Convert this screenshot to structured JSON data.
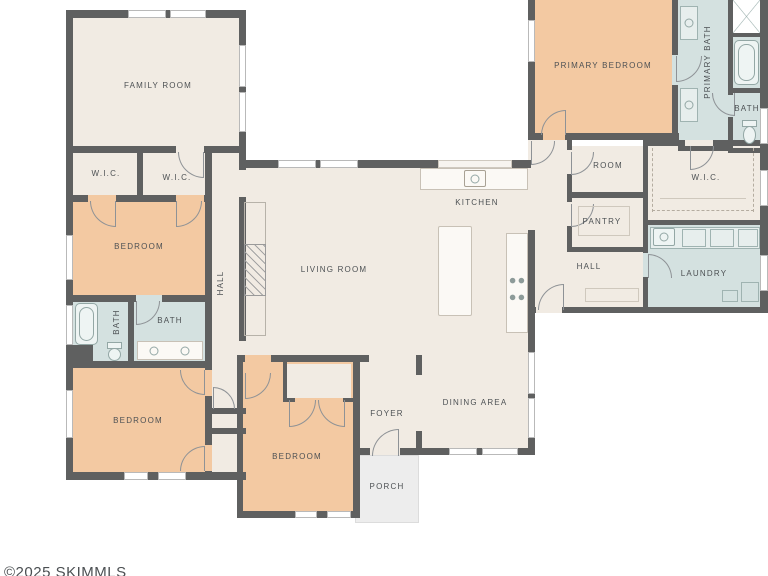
{
  "title": "Single-story house floor plan",
  "watermark": "©2025 SKIMMLS",
  "colors": {
    "background": "#ffffff",
    "wall": "#5f6060",
    "floor_common": "#f1ebe3",
    "floor_bedroom": "#f3c9a2",
    "floor_bath": "#d4e1e0",
    "floor_porch": "#ededed",
    "label_text": "#4d5154"
  },
  "rooms": {
    "family_room": "FAMILY ROOM",
    "wic_left_a": "W.I.C.",
    "wic_left_b": "W.I.C.",
    "bedroom_upper_left": "BEDROOM",
    "bath_left_a": "BATH",
    "bath_left_b": "BATH",
    "hall_left": "HALL",
    "bedroom_lower_left": "BEDROOM",
    "living_room": "LIVING ROOM",
    "kitchen": "KITCHEN",
    "bedroom_center": "BEDROOM",
    "foyer": "FOYER",
    "dining_area": "DINING AREA",
    "porch": "PORCH",
    "primary_bedroom": "PRIMARY BEDROOM",
    "primary_bath": "PRIMARY BATH",
    "bath_right": "BATH",
    "room_right": "ROOM",
    "wic_right": "W.I.C.",
    "pantry": "PANTRY",
    "hall_right": "HALL",
    "laundry": "LAUNDRY"
  }
}
